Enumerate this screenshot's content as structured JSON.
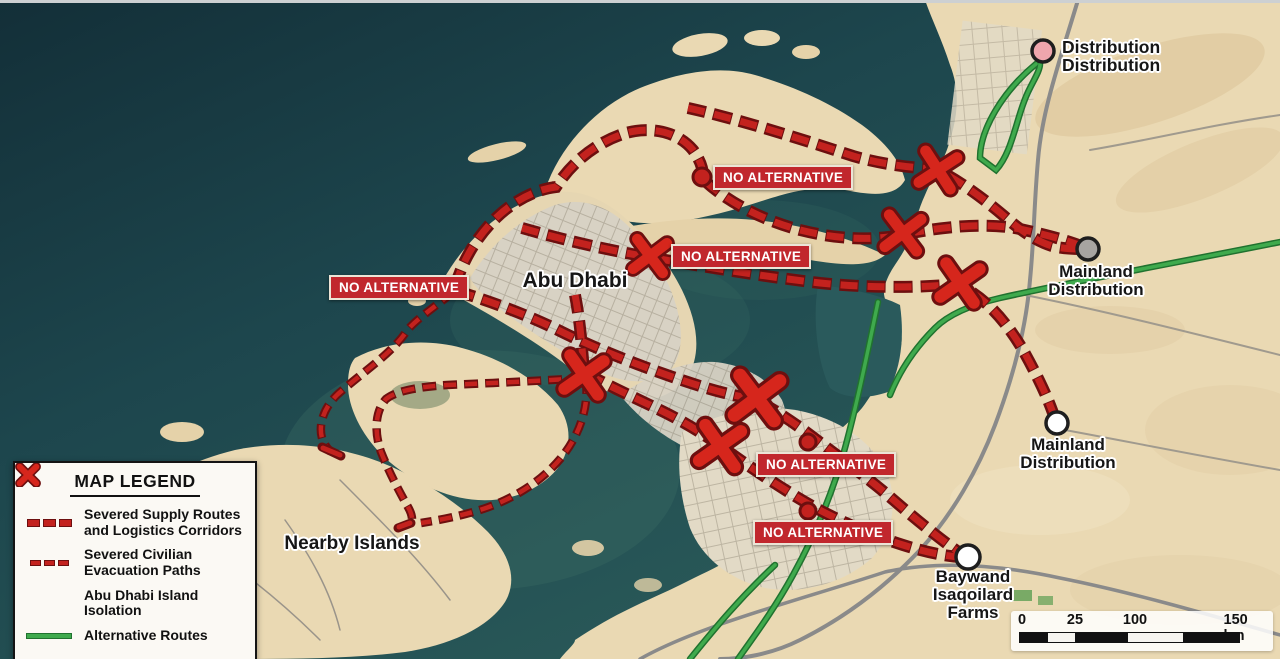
{
  "map": {
    "place_labels": {
      "abu_dhabi": "Abu Dhabi",
      "nearby_islands": "Nearby Islands"
    },
    "annotation": {
      "no_alternative": "NO ALTERNATIVE"
    },
    "endpoints": {
      "distribution_north": {
        "line1": "Distribution",
        "line2": "Distribution"
      },
      "mainland_northeast": {
        "line1": "Mainland",
        "line2": "Distribution"
      },
      "mainland_southeast": {
        "line1": "Mainland",
        "line2": "Distribution"
      },
      "baywand": {
        "line1": "Baywand",
        "line2": "Isaqoilard",
        "line3": "Farms"
      }
    },
    "isolation_x_count": 7,
    "no_alternative_count": 5
  },
  "legend": {
    "title": "MAP LEGEND",
    "items": [
      {
        "symbol": "severed-supply-dash",
        "label": "Severed Supply Routes and Logistics Corridors"
      },
      {
        "symbol": "severed-evacuation-dash",
        "label": "Severed Civilian Evacuation Paths"
      },
      {
        "symbol": "isolation-x",
        "label": "Abu Dhabi Island Isolation"
      },
      {
        "symbol": "alternative-route-line",
        "label": "Alternative Routes"
      }
    ]
  },
  "scale_bar": {
    "ticks": [
      "0",
      "25",
      "100",
      "150 km"
    ]
  },
  "colors": {
    "severed_route": "#c3221e",
    "route_outline": "#6d0f0f",
    "alternative_route": "#3faa4d",
    "alternative_outline": "#20722f",
    "badge_background": "#c1272d",
    "water": "#1c444c",
    "sand": "#ead9b3",
    "marker_pink": "#efa6ad",
    "marker_gray": "#a7a4a1",
    "marker_white": "#ffffff",
    "marker_red": "#c3221e"
  }
}
